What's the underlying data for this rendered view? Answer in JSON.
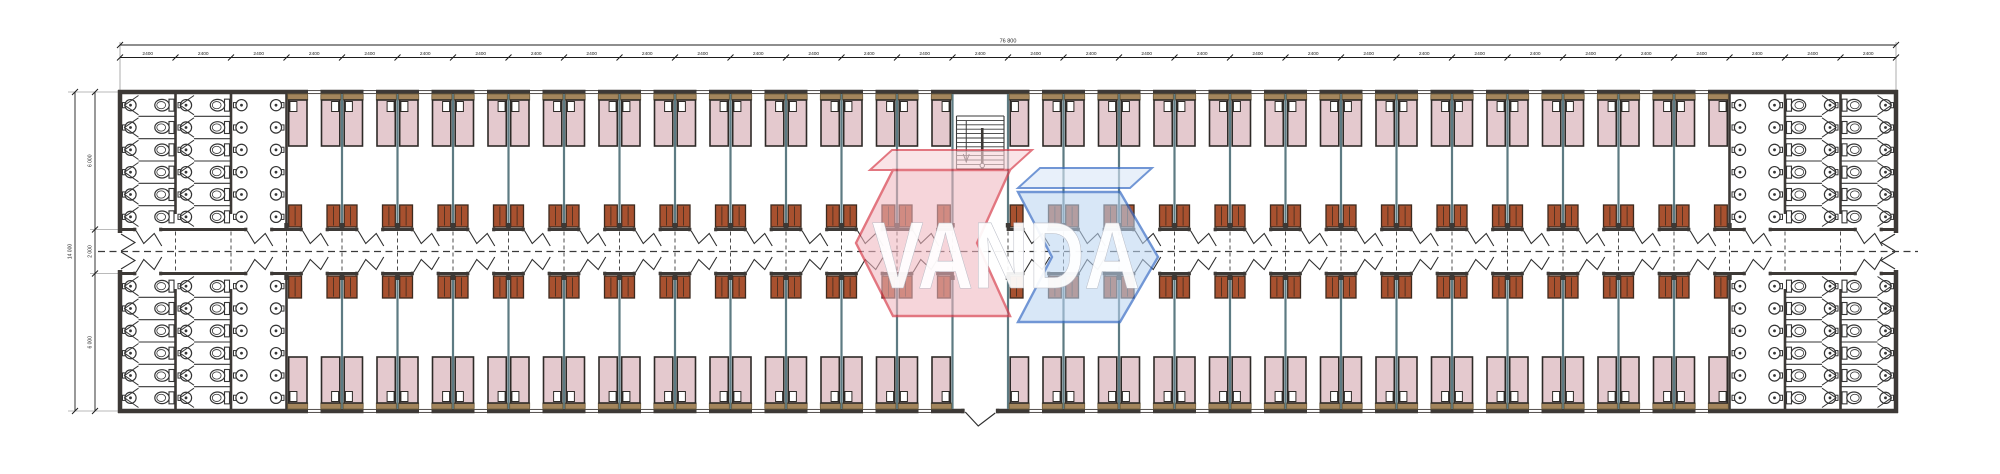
{
  "dimensions": {
    "total_width_label": "76 800",
    "bay_label": "2400",
    "overall_height_label": "14 000",
    "wing_top_label": "6 000",
    "corridor_label": "2 000",
    "wing_bottom_label": "6 000"
  },
  "plan": {
    "bay_count": 32,
    "washroom_bays_each_end": 3,
    "rooms_top_row": 25,
    "rooms_bottom_row": 25,
    "beds_per_room": 2,
    "wardrobes_per_room": 2,
    "sinks_per_column": 6,
    "toilet_stalls_per_column": 6,
    "has_central_stair": true,
    "has_bottom_entrance": true,
    "colors": {
      "wall": "#3d3936",
      "partition": "#5d7b83",
      "bed_fill": "#e4c9ce",
      "bed_stroke": "#2e2a27",
      "pillow_fill": "#ffffff",
      "headboard_fill": "#a3855c",
      "headboard_stroke": "#6b5a3a",
      "wardrobe_fill": "#a8512f",
      "wardrobe_stroke": "#3c2a1e",
      "fixture_stroke": "#343434",
      "dimension": "#1d1d1d",
      "dash": "#3a3a3a"
    }
  },
  "watermark": {
    "text": "VANDA",
    "left_fill": "#f0b6bf",
    "left_face_fill": "#f7d3d8",
    "left_stroke": "#d84250",
    "right_fill": "#bdd6f2",
    "right_face_fill": "#d9e7f7",
    "right_stroke": "#3b6fc5",
    "text_color": "#ffffff"
  }
}
